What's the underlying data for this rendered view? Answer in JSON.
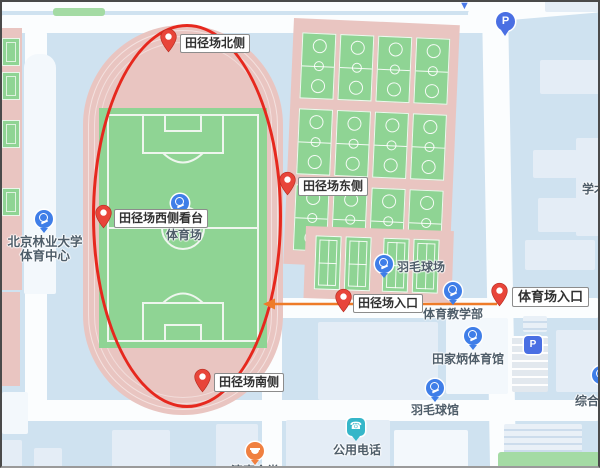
{
  "map_title": "campus sports area map",
  "colors": {
    "background": "#cfe2f0",
    "road": "#fbfdfe",
    "building": "#e4edf6",
    "track_pink": "#e9c5c1",
    "court_green": "#8fd494",
    "ellipse_red": "#e6281e",
    "arrow_orange": "#ee7b28",
    "pin_red": "#e8453a",
    "poi_blue": "#3f7ee8",
    "poi_teal": "#35b6c9",
    "poi_orange": "#f08040",
    "parking_blue": "#4a6fe3",
    "poi_text": "#4e5d69",
    "marker_text": "#303030"
  },
  "annotations": {
    "highlight_ellipse": {
      "shape": "ellipse",
      "color": "#e6281e"
    },
    "route_arrow": {
      "color": "#ee7b28",
      "direction": "left",
      "from_x": 497,
      "to_x": 264,
      "y": 304
    }
  },
  "markers": [
    {
      "label": "田径场北侧",
      "tip_x": 168,
      "tip_y": 53,
      "label_x": 180,
      "label_y": 34,
      "size": "normal"
    },
    {
      "label": "田径场东侧",
      "tip_x": 287,
      "tip_y": 196,
      "label_x": 298,
      "label_y": 177,
      "size": "normal"
    },
    {
      "label": "田径场西侧看台",
      "tip_x": 103,
      "tip_y": 229,
      "label_x": 114,
      "label_y": 209,
      "size": "normal"
    },
    {
      "label": "田径场南侧",
      "tip_x": 202,
      "tip_y": 393,
      "label_x": 214,
      "label_y": 373,
      "size": "normal"
    },
    {
      "label": "田径场入口",
      "tip_x": 343,
      "tip_y": 313,
      "label_x": 353,
      "label_y": 294,
      "size": "normal"
    },
    {
      "label": "体育场入口",
      "tip_x": 499,
      "tip_y": 307,
      "label_x": 512,
      "label_y": 287,
      "size": "large"
    }
  ],
  "pois": [
    {
      "name": "stadium",
      "label": "体育场",
      "icon": "sports",
      "x": 180,
      "y": 203,
      "text_x": 166,
      "text_y": 226
    },
    {
      "name": "badminton-courts",
      "label": "羽毛球场",
      "icon": "sports",
      "x": 384,
      "y": 264,
      "text_x": 397,
      "text_y": 258
    },
    {
      "name": "pe-teaching-dept",
      "label": "体育教学部",
      "icon": "sports",
      "x": 453,
      "y": 291,
      "text_x": 423,
      "text_y": 305
    },
    {
      "name": "tianjiabing-gym",
      "label": "田家炳体育馆",
      "icon": "sports",
      "x": 473,
      "y": 336,
      "text_x": 432,
      "text_y": 350
    },
    {
      "name": "badminton-hall",
      "label": "羽毛球馆",
      "icon": "sports",
      "x": 435,
      "y": 388,
      "text_x": 411,
      "text_y": 401
    },
    {
      "name": "public-phone",
      "label": "公用电话",
      "icon": "phone",
      "x": 356,
      "y": 427,
      "text_x": 333,
      "text_y": 441
    },
    {
      "name": "halal-canteen",
      "label": "清真食堂",
      "icon": "food",
      "x": 255,
      "y": 451,
      "text_x": 231,
      "text_y": 462
    }
  ],
  "sports_center": {
    "lines": [
      "北京林业大学",
      "体育中心"
    ],
    "icon_x": 44,
    "icon_y": 219,
    "text_x": 6,
    "text_y": 231,
    "width": 78
  },
  "edge_labels": [
    {
      "label": "学术",
      "x": 582,
      "y": 180
    },
    {
      "label": "综合",
      "x": 575,
      "y": 392
    }
  ],
  "misc_icons": {
    "parking_balloon": {
      "glyph": "P",
      "x": 496,
      "y": 12
    },
    "parking_square": {
      "glyph": "P",
      "x": 524,
      "y": 336
    },
    "top_chevron": {
      "glyph": "▼",
      "x": 459,
      "y": 0
    },
    "edge_partial_poi": {
      "x": 592,
      "y": 366
    }
  },
  "sports_areas": {
    "basketball_grid": {
      "rows": 3,
      "cols": 4
    },
    "badminton_row": {
      "count": 4
    },
    "left_strip": {
      "count": 4
    }
  }
}
